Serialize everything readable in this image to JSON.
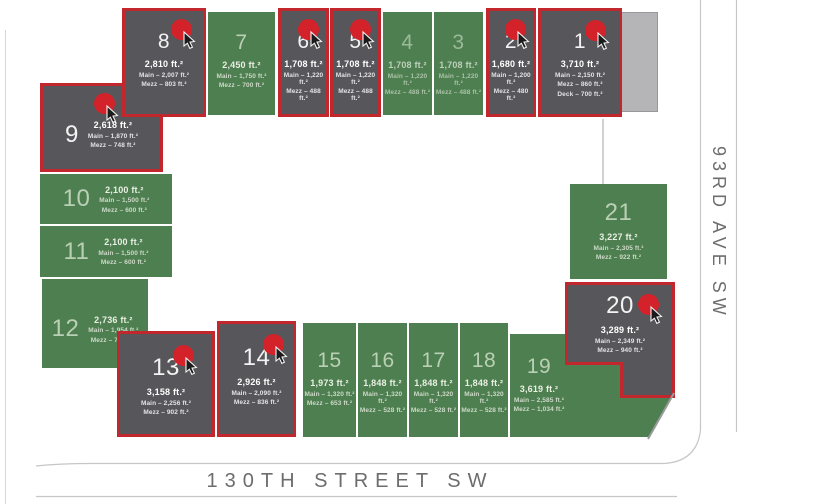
{
  "site": {
    "streets": {
      "bottom": "130TH STREET SW",
      "right": "93RD AVE SW"
    },
    "colors": {
      "available_green": "#4e7f50",
      "sold_gray": "#57575b",
      "sold_border_red": "#c1272d",
      "marker_red": "#d4222a"
    }
  },
  "units": [
    {
      "number": "1",
      "status": "sold",
      "total": "3,710 ft.²",
      "main": "Main – 2,150 ft.²",
      "mezz": "Mezz – 860 ft.²",
      "deck": "Deck – 700 ft.²"
    },
    {
      "number": "2",
      "status": "sold",
      "total": "1,680 ft.²",
      "main": "Main – 1,200 ft.²",
      "mezz": "Mezz – 480 ft.²"
    },
    {
      "number": "3",
      "status": "available",
      "total": "1,708 ft.²",
      "main": "Main – 1,220 ft.²",
      "mezz": "Mezz – 488 ft.²"
    },
    {
      "number": "4",
      "status": "available",
      "total": "1,708 ft.²",
      "main": "Main – 1,220 ft.²",
      "mezz": "Mezz – 488 ft.²"
    },
    {
      "number": "5",
      "status": "sold",
      "total": "1,708 ft.²",
      "main": "Main – 1,220 ft.²",
      "mezz": "Mezz – 488 ft.²"
    },
    {
      "number": "6",
      "status": "sold",
      "total": "1,708 ft.²",
      "main": "Main – 1,220 ft.²",
      "mezz": "Mezz – 488 ft.²"
    },
    {
      "number": "7",
      "status": "available",
      "total": "2,450 ft.²",
      "main": "Main – 1,750 ft.²",
      "mezz": "Mezz – 700 ft.²"
    },
    {
      "number": "8",
      "status": "sold",
      "total": "2,810 ft.²",
      "main": "Main – 2,007 ft.²",
      "mezz": "Mezz – 803 ft.²"
    },
    {
      "number": "9",
      "status": "sold",
      "total": "2,618 ft.²",
      "main": "Main – 1,870 ft.²",
      "mezz": "Mezz – 748 ft.²"
    },
    {
      "number": "10",
      "status": "available",
      "total": "2,100 ft.²",
      "main": "Main – 1,500 ft.²",
      "mezz": "Mezz – 600 ft.²"
    },
    {
      "number": "11",
      "status": "available",
      "total": "2,100 ft.²",
      "main": "Main – 1,500 ft.²",
      "mezz": "Mezz – 600 ft.²"
    },
    {
      "number": "12",
      "status": "available",
      "total": "2,736 ft.²",
      "main": "Main – 1,954 ft.²",
      "mezz": "Mezz – 782 ft.²"
    },
    {
      "number": "13",
      "status": "sold",
      "total": "3,158 ft.²",
      "main": "Main – 2,256 ft.²",
      "mezz": "Mezz – 902 ft.²"
    },
    {
      "number": "14",
      "status": "sold",
      "total": "2,926 ft.²",
      "main": "Main – 2,090 ft.²",
      "mezz": "Mezz – 836 ft.²"
    },
    {
      "number": "15",
      "status": "available",
      "total": "1,973 ft.²",
      "main": "Main – 1,320 ft.²",
      "mezz": "Mezz – 653 ft.²"
    },
    {
      "number": "16",
      "status": "available",
      "total": "1,848 ft.²",
      "main": "Main – 1,320 ft.²",
      "mezz": "Mezz – 528 ft.²"
    },
    {
      "number": "17",
      "status": "available",
      "total": "1,848 ft.²",
      "main": "Main – 1,320 ft.²",
      "mezz": "Mezz – 528 ft.²"
    },
    {
      "number": "18",
      "status": "available",
      "total": "1,848 ft.²",
      "main": "Main – 1,320 ft.²",
      "mezz": "Mezz – 528 ft.²"
    },
    {
      "number": "19",
      "status": "available",
      "total": "3,619 ft.²",
      "main": "Main – 2,585 ft.²",
      "mezz": "Mezz – 1,034 ft.²"
    },
    {
      "number": "20",
      "status": "sold",
      "total": "3,289 ft.²",
      "main": "Main – 2,349 ft.²",
      "mezz": "Mezz – 940 ft.²"
    },
    {
      "number": "21",
      "status": "available",
      "total": "3,227 ft.²",
      "main": "Main – 2,305 ft.²",
      "mezz": "Mezz – 922 ft.²"
    }
  ]
}
